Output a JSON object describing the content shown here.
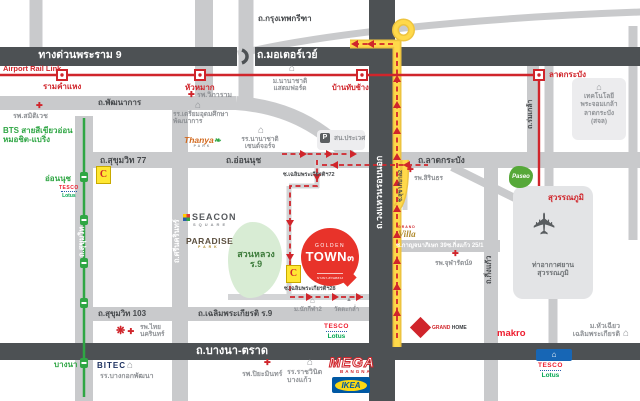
{
  "colors": {
    "red": "#d0252b",
    "route_yellow": "#ffd633",
    "dark_road": "#4d5154",
    "road_gray": "#c9cacc",
    "bts_green": "#2fa644"
  },
  "icons": {
    "hospital_cross": "✚",
    "building": "⌂",
    "temple": "▲",
    "plane": "✈",
    "police": "P",
    "star": "❋",
    "bigc": "C"
  },
  "roads": {
    "expressway": "ทางด่วนพระราม 9",
    "motorway": "ถ.มอเตอร์เวย์",
    "krungthep_kreetha": "ถ.กรุงเทพกรีฑา",
    "phatthanakan": "ถ.พัฒนาการ",
    "sukhumvit77": "ถ.สุขุมวิท 77",
    "onnut": "ถ.อ่อนนุช",
    "lat_krabang": "ถ.ลาดกระบัง",
    "sukhumvit": "ถ.สุขุมวิท",
    "sukhumvit103": "ถ.สุขุมวิท 103",
    "srinakarin": "ถ.ศรีนครินทร์",
    "ring_road": "ถ.วงแหวนรอบนอก",
    "rom_klao": "ถ.ร่มเกล้า",
    "king_kaew": "ถ.กิ่งแก้ว",
    "chalerm_prakiat": "ถ.เฉลิมพระเกียรติ ร.9",
    "bangna_trat": "ถ.บางนา-ตราด",
    "soi_chalerm72": "ซ.เฉลิมพระเกียรติฯ72",
    "soi_chalerm28": "ซ.เฉลิมพระเกียรติฯ28",
    "soi_kanchana39": "ซ.กาญจนาภิเษก 39",
    "soi_kingkaew25": "ซ.กิ่งแก้ว 25/1",
    "soi_sukhaphiban2": "ซ.สุขาภิบาล2"
  },
  "transit": {
    "arl": "Airport Rail Link",
    "bts_line1": "BTS สายสีเขียวอ่อน",
    "bts_line2": "หมอชิต-แบริ่ง",
    "st_ramkhamhaeng": "รามคำแหง",
    "st_huamak": "หัวหมาก",
    "st_banthapchang": "บ้านทับช้าง",
    "st_latkrabang": "ลาดกระบัง",
    "st_suvarnabhumi": "สุวรรณภูมิ",
    "st_onnut": "อ่อนนุช",
    "st_bangna": "บางนา"
  },
  "project": {
    "top": "GOLDEN",
    "main": "TOWN",
    "num": "๓",
    "sub": "บางนา-สวนหลวง"
  },
  "places": {
    "samitivej": "รพ.สมิติเวช",
    "vibharam": "รพ.วิภาราม",
    "stamford1": "ม.นานาชาติ",
    "stamford2": "แสตมฟอร์ด",
    "triamudom1": "รร.เตรียมอุดมศึกษา",
    "triamudom2": "พัฒนาการ",
    "thanya1": "Thanya",
    "thanya2": "PARK",
    "intschool1": "รร.นานาชาติ",
    "intschool2": "เซนต์จอร์จ",
    "prawet": "สน.ประเวศ",
    "kmitl1": "เทคโนโลยี",
    "kmitl2": "พระจอมเกล้า",
    "kmitl3": "ลาดกระบัง",
    "kmitl4": "(สจล)",
    "sirindhorn": "รพ.สิรินธร",
    "paseo": "Paseo",
    "chularat": "รพ.จุฬารัตน์9",
    "villa1": "GRAND",
    "villa2": "Villa",
    "seacon1": "SEACON",
    "seacon2": "SQUARE",
    "paradise1": "PARADISE",
    "paradise2": "PARK",
    "park1": "สวนหลวง",
    "park2": "ร.9",
    "nakkila": "ม.นักกีฬา2",
    "wattakram": "วัดตะกล่ำ",
    "tesco": "TESCO",
    "lotus": "Lotus",
    "thainakarin1": "รพ.ไทย",
    "thainakarin2": "นครินทร์",
    "bitec": "BITEC",
    "patana": "รร.บางกอกพัฒนา",
    "piyamin": "รพ.ปิยะมินทร์",
    "rajwinit1": "รร.ราชวินิต",
    "rajwinit2": "บางแก้ว",
    "mega1": "MEGA",
    "mega2": "BANGNA",
    "ikea": "IKEA",
    "grandhome1": "GRAND",
    "grandhome2": "HOME",
    "makro": "makro",
    "huachiew1": "ม.หัวเฉียว",
    "huachiew2": "เฉลิมพระเกียรติ",
    "airport1": "ท่าอากาศยาน",
    "airport2": "สุวรรณภูมิ"
  }
}
